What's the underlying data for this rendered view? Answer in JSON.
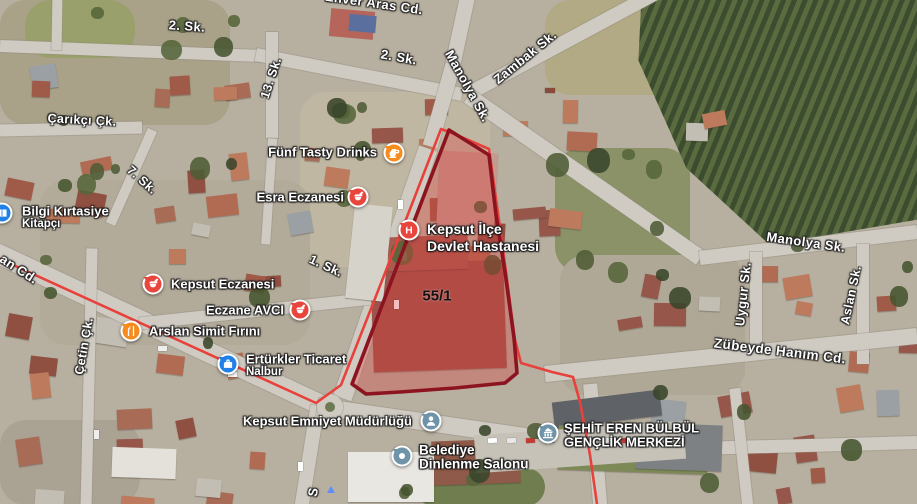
{
  "map": {
    "type_note": "satellite imagery with place labels",
    "parcel": {
      "label": "55/1",
      "label_x": 437,
      "label_y": 296,
      "label_fs": 15,
      "outline_color": "#8C1420",
      "fill_color": "rgba(221,58,58,0.33)",
      "points": "449,130 489,155 496,215 505,272 514,338 517,373 505,383 455,388 400,392 366,394 352,384"
    },
    "boundary_line": {
      "color": "#E8413C",
      "points": "0,259 316,403 341,385 376,296 412,204 441,129 452,133 489,149 498,213 506,272 515,340 521,363 552,372 573,377 580,402 590,455 597,504"
    },
    "street_labels": [
      {
        "text": "Enver Aras Cd.",
        "x": 374,
        "y": 3,
        "rot": 8,
        "fs": 13
      },
      {
        "text": "2. Sk.",
        "x": 187,
        "y": 26,
        "rot": 4,
        "fs": 13
      },
      {
        "text": "2. Sk.",
        "x": 399,
        "y": 57,
        "rot": 10,
        "fs": 13
      },
      {
        "text": "Manolya Sk.",
        "x": 468,
        "y": 86,
        "rot": 61,
        "fs": 13
      },
      {
        "text": "Zambak Sk.",
        "x": 525,
        "y": 57,
        "rot": -39,
        "fs": 13
      },
      {
        "text": "13. Sk.",
        "x": 271,
        "y": 78,
        "rot": -72,
        "fs": 12.5
      },
      {
        "text": "Çarıkçı Çk.",
        "x": 82,
        "y": 120,
        "rot": 3,
        "fs": 12.5
      },
      {
        "text": "7. Sk.",
        "x": 142,
        "y": 180,
        "rot": 42,
        "fs": 12.5
      },
      {
        "text": "an Cd.",
        "x": 19,
        "y": 269,
        "rot": 33,
        "fs": 13
      },
      {
        "text": "1. Sk.",
        "x": 326,
        "y": 266,
        "rot": 25,
        "fs": 12.5
      },
      {
        "text": "Çetin Çk.",
        "x": 84,
        "y": 346,
        "rot": -80,
        "fs": 12.5
      },
      {
        "text": "Manolya Sk.",
        "x": 806,
        "y": 242,
        "rot": 8,
        "fs": 13
      },
      {
        "text": "Uygur Sk.",
        "x": 743,
        "y": 294,
        "rot": -84,
        "fs": 13
      },
      {
        "text": "Aslan Sk.",
        "x": 851,
        "y": 295,
        "rot": -78,
        "fs": 12.5
      },
      {
        "text": "Zübeyde Hanım Cd.",
        "x": 780,
        "y": 351,
        "rot": 7,
        "fs": 13.5
      },
      {
        "text": "S",
        "x": 313,
        "y": 492,
        "rot": -80,
        "fs": 13
      }
    ],
    "pois": [
      {
        "name": "funf-tasty-drinks",
        "marker": {
          "x": 394,
          "y": 153,
          "color": "#F68C1E",
          "icon": "cafe-icon"
        },
        "label": {
          "x": 377,
          "align": "right",
          "lines": [
            {
              "text": "Fünf Tasty Drinks",
              "y": 152,
              "fs": 13
            }
          ]
        }
      },
      {
        "name": "esra-eczanesi",
        "marker": {
          "x": 358,
          "y": 197,
          "color": "#E8453C",
          "icon": "pharmacy-icon"
        },
        "label": {
          "x": 344,
          "align": "right",
          "lines": [
            {
              "text": "Esra Eczanesi",
              "y": 197,
              "fs": 13
            }
          ]
        }
      },
      {
        "name": "kepsut-ilce-devlet-hastanesi",
        "marker": {
          "x": 409,
          "y": 230,
          "color": "#E8453C",
          "icon": "hospital-icon"
        },
        "label": {
          "x": 427,
          "align": "left",
          "lines": [
            {
              "text": "Kepsut İlçe",
              "y": 229,
              "fs": 14
            },
            {
              "text": "Devlet Hastanesi",
              "y": 246,
              "fs": 14
            }
          ]
        }
      },
      {
        "name": "kepsut-eczanesi",
        "marker": {
          "x": 153,
          "y": 284,
          "color": "#E8453C",
          "icon": "pharmacy-icon"
        },
        "label": {
          "x": 171,
          "align": "left",
          "lines": [
            {
              "text": "Kepsut Eczanesi",
              "y": 284,
              "fs": 13
            }
          ]
        }
      },
      {
        "name": "eczane-avci",
        "marker": {
          "x": 300,
          "y": 310,
          "color": "#E8453C",
          "icon": "pharmacy-icon"
        },
        "label": {
          "x": 284,
          "align": "right",
          "lines": [
            {
              "text": "Eczane AVCI",
              "y": 310,
              "fs": 13
            }
          ]
        }
      },
      {
        "name": "arslan-simit-firini",
        "marker": {
          "x": 131,
          "y": 331,
          "color": "#F68C1E",
          "icon": "restaurant-icon"
        },
        "label": {
          "x": 149,
          "align": "left",
          "lines": [
            {
              "text": "Arslan Simit Fırını",
              "y": 331,
              "fs": 13
            }
          ]
        }
      },
      {
        "name": "erturkler-ticaret",
        "marker": {
          "x": 228,
          "y": 364,
          "color": "#2080E8",
          "icon": "shopping-icon"
        },
        "label": {
          "x": 246,
          "align": "left",
          "lines": [
            {
              "text": "Ertürkler Ticaret",
              "y": 359,
              "fs": 13
            },
            {
              "text": "Nalbur",
              "y": 372,
              "fs": 11.5
            }
          ]
        }
      },
      {
        "name": "bilgi-kirtasiye",
        "marker": {
          "x": 2,
          "y": 213,
          "color": "#2080E8",
          "icon": "book-icon"
        },
        "label": {
          "x": 22,
          "align": "left",
          "lines": [
            {
              "text": "Bilgi Kırtasiye",
              "y": 211,
              "fs": 13
            },
            {
              "text": "Kitapçı",
              "y": 224,
              "fs": 11.5
            }
          ]
        }
      },
      {
        "name": "kepsut-emniyet-mudurlugu",
        "marker": {
          "x": 431,
          "y": 421,
          "color": "#6F93A8",
          "icon": "police-icon"
        },
        "label": {
          "x": 412,
          "align": "right",
          "lines": [
            {
              "text": "Kepsut Emniyet Müdürlüğü",
              "y": 421,
              "fs": 13
            }
          ]
        }
      },
      {
        "name": "belediye-dinlenme-salonu",
        "marker": {
          "x": 402,
          "y": 456,
          "color": "#6F93A8",
          "icon": "dot-icon"
        },
        "label": {
          "x": 419,
          "align": "left",
          "lines": [
            {
              "text": "Belediye",
              "y": 450,
              "fs": 13.5
            },
            {
              "text": "Dinlenme Salonu",
              "y": 464,
              "fs": 13.5
            }
          ]
        }
      },
      {
        "name": "sehit-eren-bulbul-genclik-merkezi",
        "marker": {
          "x": 548,
          "y": 433,
          "color": "#6F93A8",
          "icon": "bank-icon"
        },
        "label": {
          "x": 564,
          "align": "left",
          "lines": [
            {
              "text": "ŞEHİT EREN BÜLBÜL",
              "y": 428,
              "fs": 13
            },
            {
              "text": "GENÇLİK MERKEZİ",
              "y": 442,
              "fs": 13
            }
          ]
        }
      }
    ]
  }
}
